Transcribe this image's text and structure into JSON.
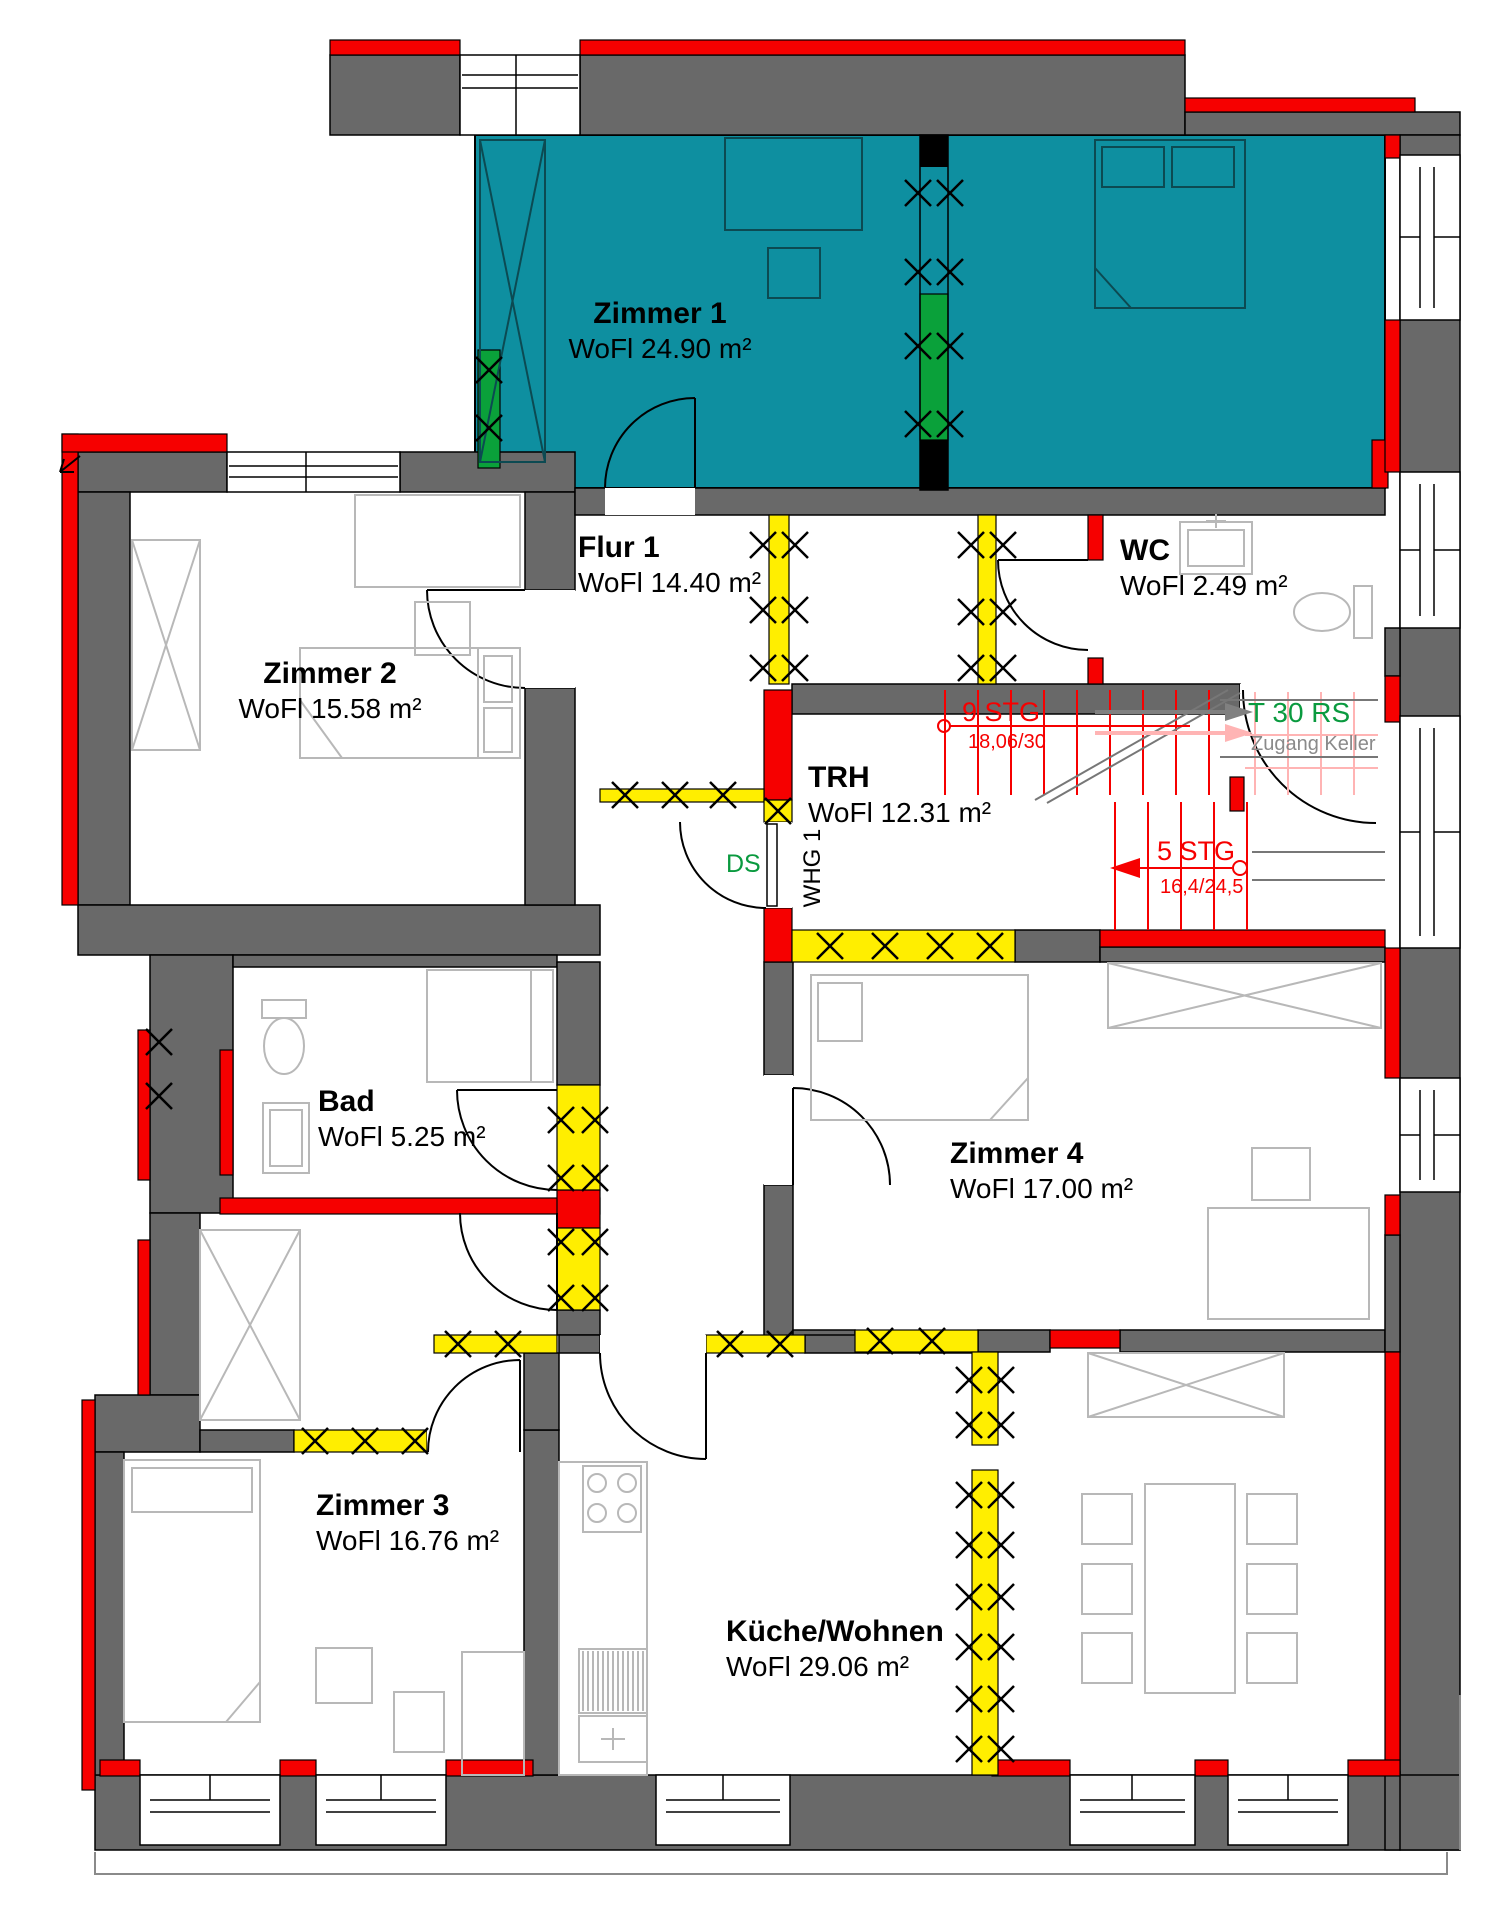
{
  "rooms": [
    {
      "id": "zimmer1",
      "name": "Zimmer 1",
      "area": "WoFl 24.90 m²"
    },
    {
      "id": "zimmer2",
      "name": "Zimmer 2",
      "area": "WoFl 15.58 m²"
    },
    {
      "id": "flur1",
      "name": "Flur 1",
      "area": "WoFl 14.40 m²"
    },
    {
      "id": "wc",
      "name": "WC",
      "area": "WoFl 2.49 m²"
    },
    {
      "id": "trh",
      "name": "TRH",
      "area": "WoFl 12.31 m²"
    },
    {
      "id": "bad",
      "name": "Bad",
      "area": "WoFl 5.25 m²"
    },
    {
      "id": "zimmer4",
      "name": "Zimmer 4",
      "area": "WoFl 17.00 m²"
    },
    {
      "id": "zimmer3",
      "name": "Zimmer 3",
      "area": "WoFl 16.76 m²"
    },
    {
      "id": "kueche",
      "name": "Küche/Wohnen",
      "area": "WoFl 29.06 m²"
    }
  ],
  "stairs": {
    "up_label": "9 STG",
    "up_dim": "18,06/30",
    "down_label": "5 STG",
    "down_dim": "16,4/24,5"
  },
  "entry_door": {
    "label": "T 30 RS",
    "sublabel": "Zugang Keller"
  },
  "marks": {
    "ds": "DS",
    "whg": "WHG 1"
  },
  "colors": {
    "teal": "#0e8fa0",
    "red": "#f60000",
    "yellow": "#ffee00",
    "green": "#0aa13a",
    "wall": "#696969",
    "pink": "#ffb4b4",
    "furn": "#b8b8b8",
    "txtgreen": "#0a9a3f"
  }
}
